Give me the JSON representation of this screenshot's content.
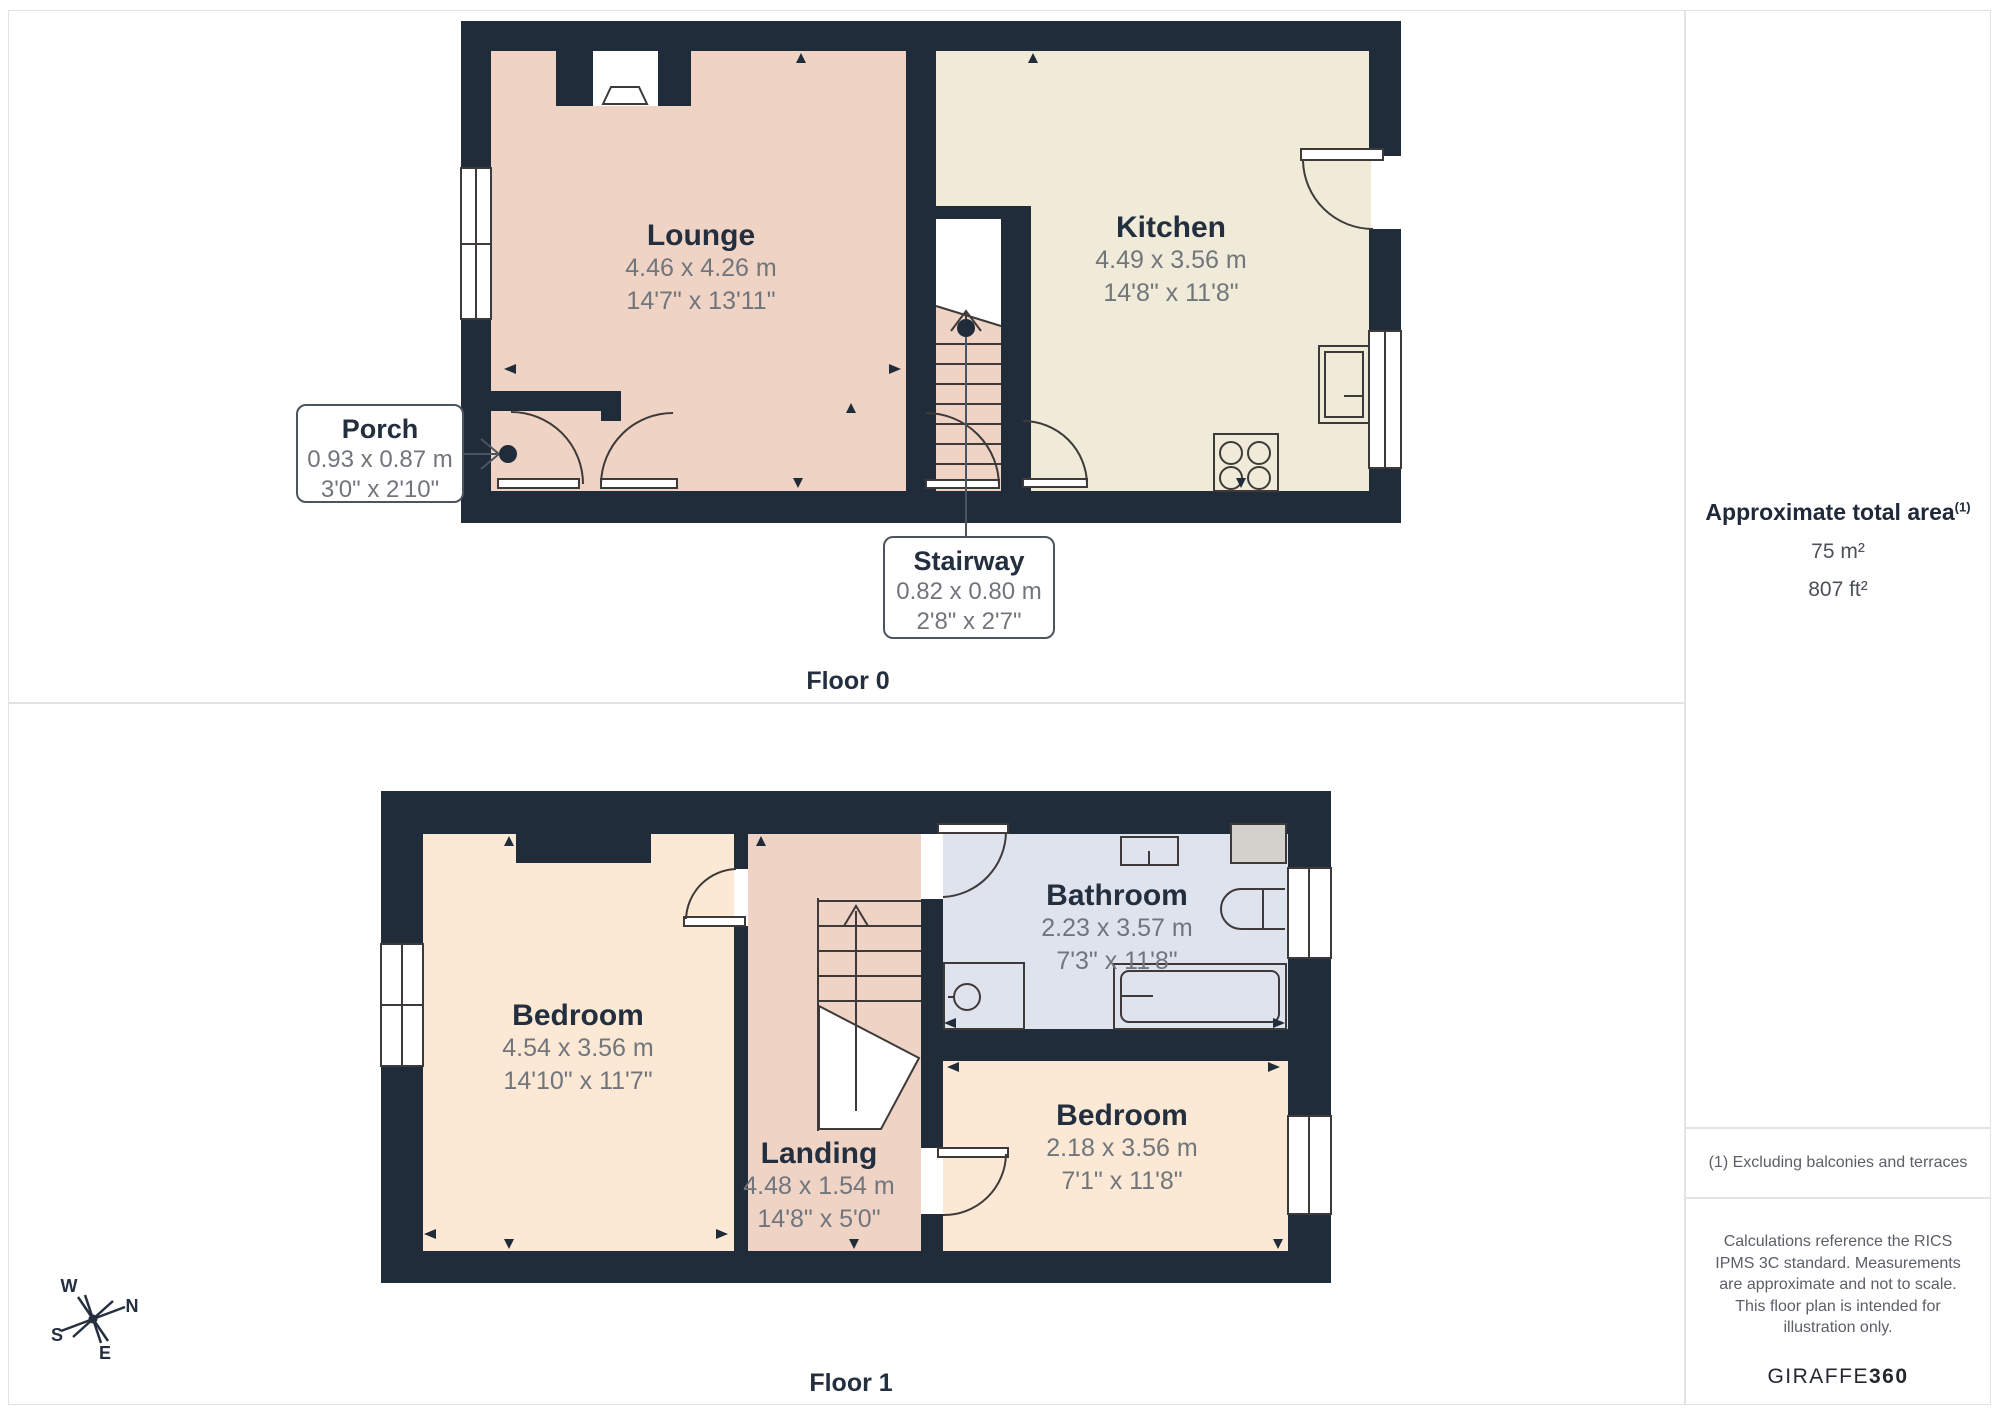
{
  "floor0": {
    "caption": "Floor 0",
    "lounge": {
      "name": "Lounge",
      "dim_m": "4.46 x 4.26 m",
      "dim_ft": "14'7\" x 13'11\""
    },
    "kitchen": {
      "name": "Kitchen",
      "dim_m": "4.49 x 3.56 m",
      "dim_ft": "14'8\" x 11'8\""
    },
    "porch": {
      "name": "Porch",
      "dim_m": "0.93 x 0.87 m",
      "dim_ft": "3'0\" x 2'10\""
    },
    "stairway": {
      "name": "Stairway",
      "dim_m": "0.82 x 0.80 m",
      "dim_ft": "2'8\" x 2'7\""
    }
  },
  "floor1": {
    "caption": "Floor 1",
    "bedroom1": {
      "name": "Bedroom",
      "dim_m": "4.54 x 3.56 m",
      "dim_ft": "14'10\" x 11'7\""
    },
    "bathroom": {
      "name": "Bathroom",
      "dim_m": "2.23 x 3.57 m",
      "dim_ft": "7'3\" x 11'8\""
    },
    "landing": {
      "name": "Landing",
      "dim_m": "4.48 x 1.54 m",
      "dim_ft": "14'8\" x 5'0\""
    },
    "bedroom2": {
      "name": "Bedroom",
      "dim_m": "2.18 x 3.56 m",
      "dim_ft": "7'1\" x 11'8\""
    }
  },
  "sidebar": {
    "area_title": "Approximate total area",
    "area_sup": "(1)",
    "area_m2": "75 m²",
    "area_ft2": "807 ft²",
    "footnote": "(1) Excluding balconies and terraces",
    "disclaimer": "Calculations reference the RICS IPMS 3C standard. Measurements are approximate and not to scale. This floor plan is intended for illustration only.",
    "brand_name": "GIRAFFE",
    "brand_suffix": "360"
  },
  "compass": {
    "n": "N",
    "e": "E",
    "s": "S",
    "w": "W"
  },
  "colors": {
    "wall": "#212c3a",
    "lounge_floor": "#efd4c6",
    "kitchen_floor": "#f0ead8",
    "bedroom_floor": "#fbe9d5",
    "bathroom_floor": "#dfe3ee",
    "appliance_gray": "#d3d1cb",
    "line": "#4a5560"
  }
}
